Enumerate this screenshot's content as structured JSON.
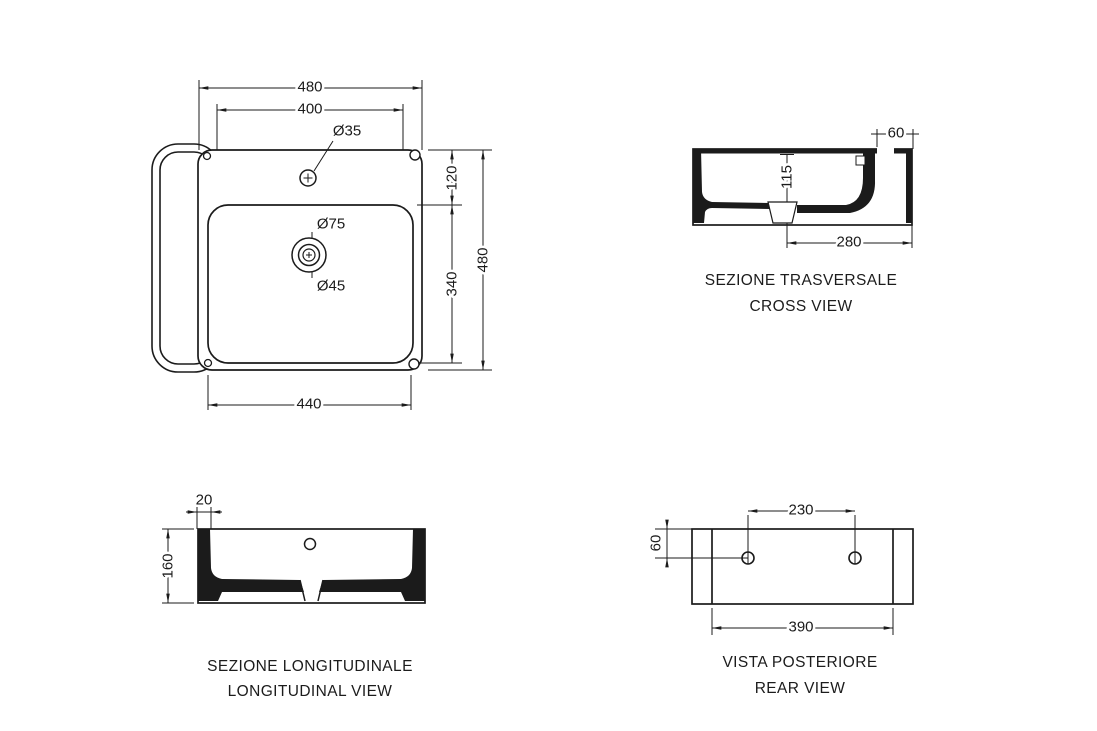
{
  "page": {
    "background": "#ffffff",
    "line_color": "#1b1b1b"
  },
  "views": {
    "plan": {
      "dims": {
        "overall_width": "480",
        "top_width": "400",
        "tap_hole_diameter": "Ø35",
        "deck_depth": "120",
        "bowl_depth": "340",
        "overall_depth": "480",
        "bowl_width": "440",
        "drain_outer_diameter": "Ø75",
        "drain_inner_diameter": "Ø45"
      }
    },
    "cross": {
      "caption_it": "SEZIONE TRASVERSALE",
      "caption_en": "CROSS VIEW",
      "dims": {
        "overflow_width": "60",
        "inner_height": "115",
        "drain_to_back": "280"
      }
    },
    "longitudinal": {
      "caption_it": "SEZIONE LONGITUDINALE",
      "caption_en": "LONGITUDINAL VIEW",
      "dims": {
        "wall_thickness": "20",
        "overall_height": "160"
      }
    },
    "rear": {
      "caption_it": "VISTA POSTERIORE",
      "caption_en": "REAR VIEW",
      "dims": {
        "fixing_hole_spacing": "230",
        "fixing_hole_offset": "60",
        "mounting_width": "390"
      }
    }
  }
}
